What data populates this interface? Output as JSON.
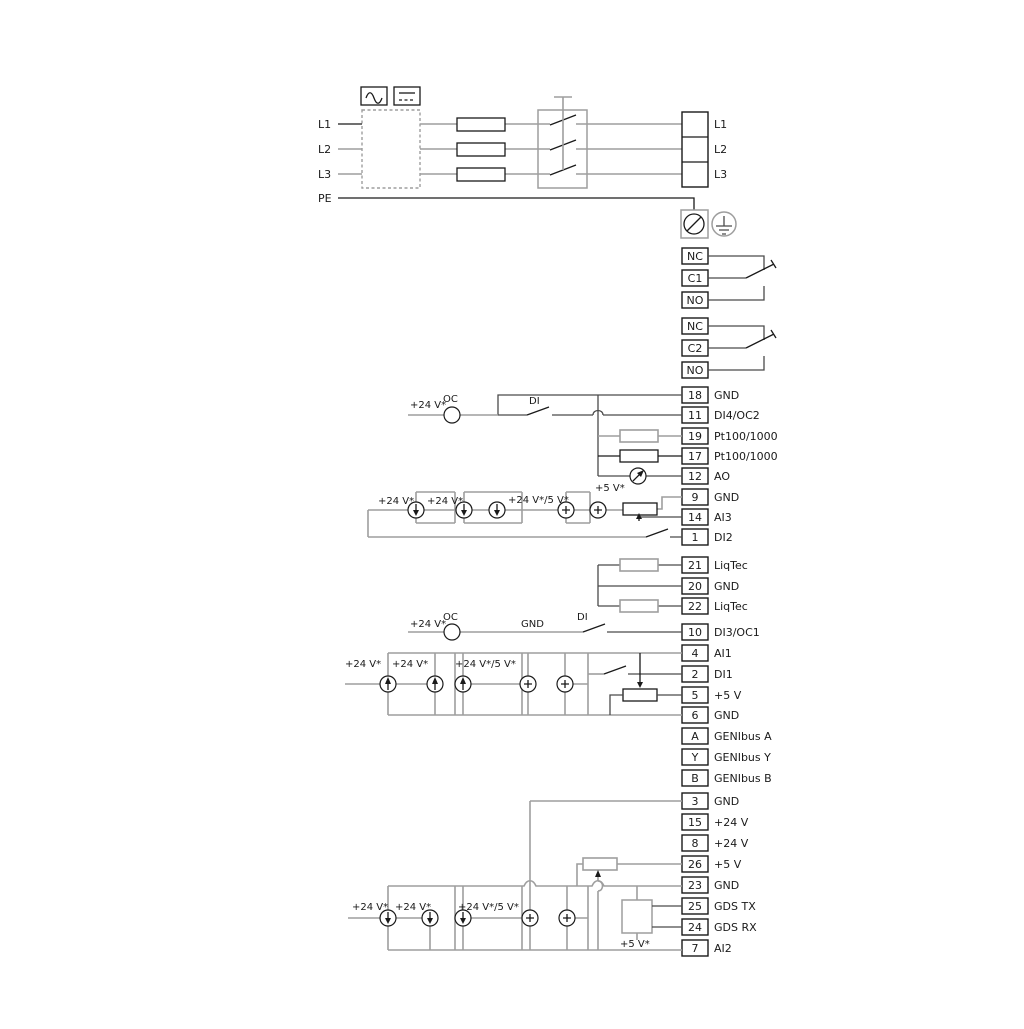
{
  "labels": {
    "v24": "+24 V*",
    "v245": "+24 V*/5 V*",
    "v5": "+5 V*",
    "oc": "OC",
    "di": "DI",
    "gnd": "GND"
  },
  "colors": {
    "wire_gray": "#9e9e9e",
    "wire_dark": "#4a4a4a",
    "line_black": "#1a1a1a"
  },
  "power": {
    "inputs": [
      "L1",
      "L2",
      "L3",
      "PE"
    ],
    "outputs": [
      "L1",
      "L2",
      "L3"
    ]
  },
  "relays": {
    "r1": [
      "NC",
      "C1",
      "NO"
    ],
    "r2": [
      "NC",
      "C2",
      "NO"
    ]
  },
  "blocks": {
    "b1": {
      "rows": [
        {
          "num": "18",
          "label": "GND"
        },
        {
          "num": "11",
          "label": "DI4/OC2"
        },
        {
          "num": "19",
          "label": "Pt100/1000"
        },
        {
          "num": "17",
          "label": "Pt100/1000"
        },
        {
          "num": "12",
          "label": "AO"
        },
        {
          "num": "9",
          "label": "GND"
        },
        {
          "num": "14",
          "label": "AI3"
        },
        {
          "num": "1",
          "label": "DI2"
        }
      ]
    },
    "liqtec": {
      "rows": [
        {
          "num": "21",
          "label": "LiqTec"
        },
        {
          "num": "20",
          "label": "GND"
        },
        {
          "num": "22",
          "label": "LiqTec"
        }
      ]
    },
    "b2": {
      "rows": [
        {
          "num": "10",
          "label": "DI3/OC1"
        },
        {
          "num": "4",
          "label": "AI1"
        },
        {
          "num": "2",
          "label": "DI1"
        },
        {
          "num": "5",
          "label": "+5 V"
        },
        {
          "num": "6",
          "label": "GND"
        },
        {
          "num": "A",
          "label": "GENIbus A"
        },
        {
          "num": "Y",
          "label": "GENIbus Y"
        },
        {
          "num": "B",
          "label": "GENIbus B"
        }
      ]
    },
    "b3": {
      "rows": [
        {
          "num": "3",
          "label": "GND"
        },
        {
          "num": "15",
          "label": "+24 V"
        },
        {
          "num": "8",
          "label": "+24 V"
        },
        {
          "num": "26",
          "label": "+5 V"
        },
        {
          "num": "23",
          "label": "GND"
        },
        {
          "num": "25",
          "label": "GDS TX"
        },
        {
          "num": "24",
          "label": "GDS RX"
        },
        {
          "num": "7",
          "label": "AI2"
        }
      ]
    }
  }
}
